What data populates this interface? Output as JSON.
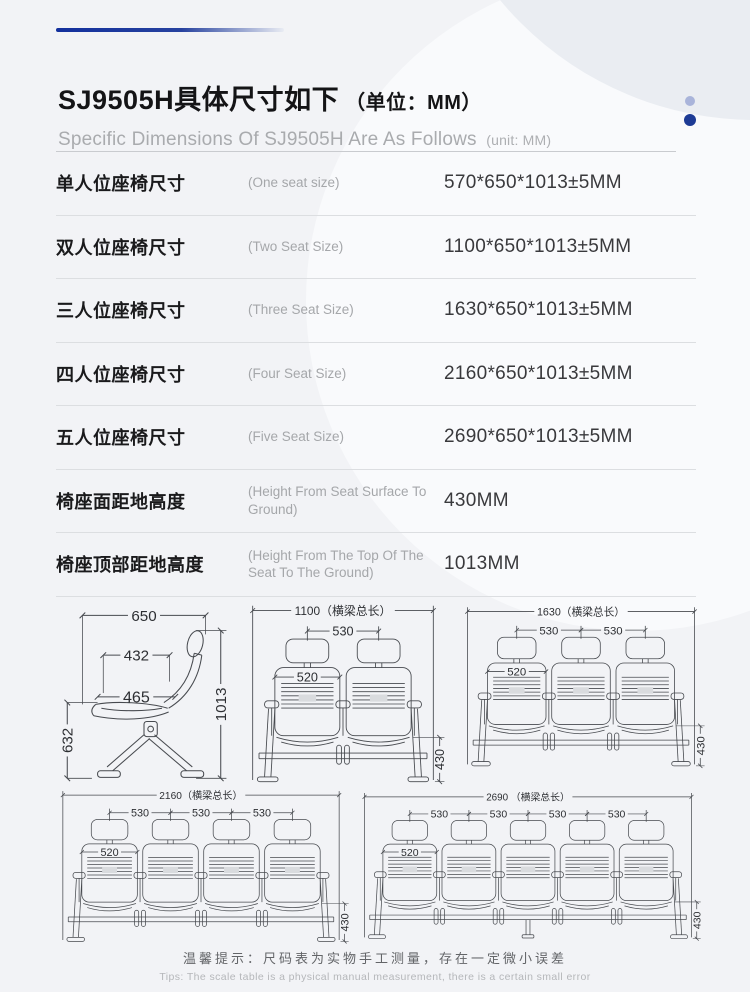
{
  "header": {
    "title_cn": "SJ9505H具体尺寸如下",
    "title_unit": "（单位：MM）",
    "subtitle_en": "Specific Dimensions Of SJ9505H Are As Follows",
    "subtitle_unit": "(unit: MM)"
  },
  "table": {
    "rows": [
      {
        "label_cn": "单人位座椅尺寸",
        "label_en": "(One seat size)",
        "value": "570*650*1013±5MM"
      },
      {
        "label_cn": "双人位座椅尺寸",
        "label_en": "(Two Seat Size)",
        "value": "1100*650*1013±5MM"
      },
      {
        "label_cn": "三人位座椅尺寸",
        "label_en": "(Three Seat Size)",
        "value": "1630*650*1013±5MM"
      },
      {
        "label_cn": "四人位座椅尺寸",
        "label_en": "(Four Seat Size)",
        "value": "2160*650*1013±5MM"
      },
      {
        "label_cn": "五人位座椅尺寸",
        "label_en": "(Five Seat Size)",
        "value": "2690*650*1013±5MM"
      },
      {
        "label_cn": "椅座面距地高度",
        "label_en": "(Height From Seat Surface To Ground)",
        "value": "430MM"
      },
      {
        "label_cn": "椅座顶部距地高度",
        "label_en": "(Height From The Top Of The Seat To The Ground)",
        "value": "1013MM"
      }
    ]
  },
  "drawings": {
    "side_view": {
      "top_depth": "650",
      "back_width": "432",
      "seat_depth": "465",
      "seat_frame_height": "632",
      "total_height": "1013"
    },
    "front_views": [
      {
        "seats": 2,
        "total_label": "1100（横梁总长）",
        "spacing": "530",
        "seat_width": "520",
        "seat_height": "430"
      },
      {
        "seats": 3,
        "total_label": "1630（横梁总长）",
        "spacing": "530",
        "seat_width": "520",
        "seat_height": "430"
      },
      {
        "seats": 4,
        "total_label": "2160（横梁总长）",
        "spacing": "530",
        "seat_width": "520",
        "seat_height": "430"
      },
      {
        "seats": 5,
        "total_label": "2690 （横梁总长）",
        "spacing": "530",
        "seat_width": "520",
        "seat_height": "430"
      }
    ]
  },
  "footer": {
    "tip_cn": "温馨提示：尺码表为实物手工测量，存在一定微小误差",
    "tip_en": "Tips: The scale table is a physical manual measurement, there is a certain small error"
  },
  "colors": {
    "accent_blue": "#13309d",
    "dot_light": "#a9b4da",
    "dot_dark": "#1d3b95",
    "line_stroke": "#474a4f",
    "dim_text": "#2d2f33",
    "page_bg": "#f2f3f6"
  }
}
